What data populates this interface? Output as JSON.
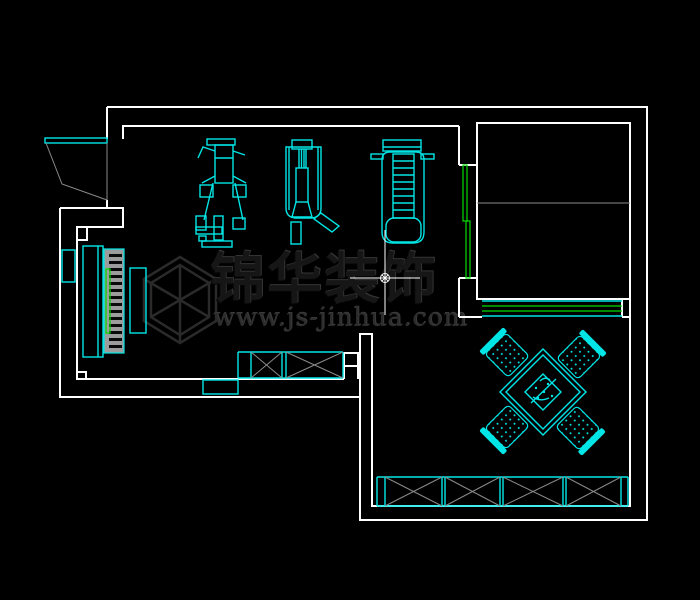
{
  "canvas": {
    "width": 700,
    "height": 600
  },
  "colors": {
    "bg": "#000000",
    "wall": "#ffffff",
    "furn": "#00e6e6",
    "open": "#00dd00",
    "hatch": "#8a8a8a",
    "keys-bg": "#9c9c9c",
    "wm-stroke": "#2a2a2a",
    "wm-text": "#161616",
    "wm-url": "#2c2c2c"
  },
  "watermark": {
    "brand": "锦华装饰",
    "url": "www.js-jinhua.com",
    "logo": "isometric-cube-logo"
  },
  "elements": {
    "doors": [
      "entry-swing-door",
      "bedroom-sliding-door"
    ],
    "windows": [
      "bedroom-window-band"
    ],
    "furniture": [
      "piano-with-keys",
      "piano-bench",
      "exercise-machine",
      "pulldown-machine",
      "treadmill",
      "crossed-wardrobe",
      "low-cabinet",
      "rotated-dining-table",
      "dining-chair-x4",
      "crossed-storage-cabinets-x4"
    ],
    "annotations": [
      "crosshair-point-marker",
      "room-divider-line"
    ]
  }
}
